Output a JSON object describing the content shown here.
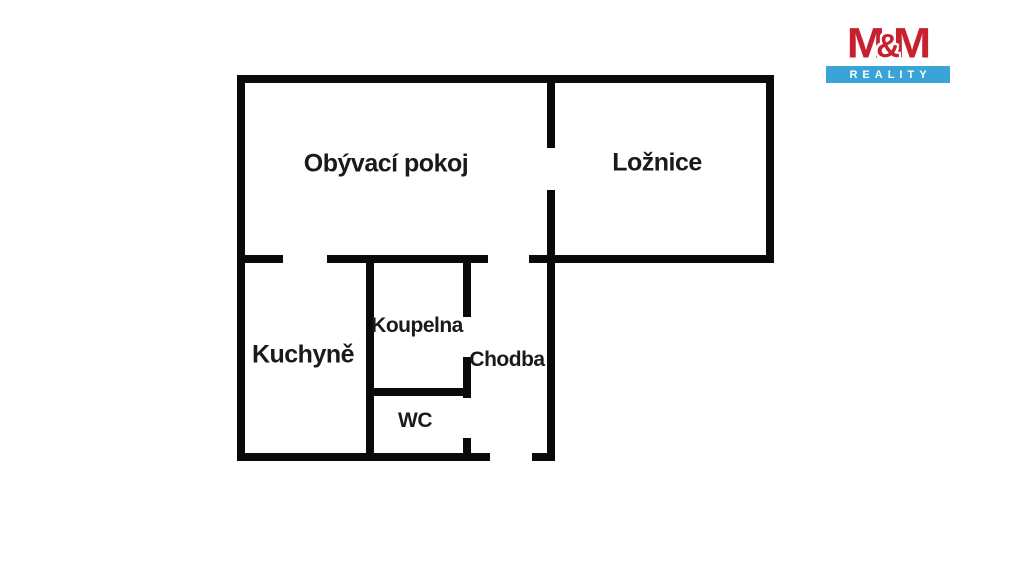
{
  "floorplan": {
    "wall_color": "#0a0a0a",
    "rooms": [
      {
        "id": "obyvaci-pokoj",
        "label": "Obývací pokoj"
      },
      {
        "id": "loznice",
        "label": "Ložnice"
      },
      {
        "id": "kuchyne",
        "label": "Kuchyně"
      },
      {
        "id": "koupelna",
        "label": "Koupelna"
      },
      {
        "id": "chodba",
        "label": "Chodba"
      },
      {
        "id": "wc",
        "label": "WC"
      }
    ]
  },
  "logo": {
    "brand": "M&M",
    "m1": "M",
    "amp": "&",
    "m2": "M",
    "tagline": "REALITY",
    "colors": {
      "red": "#c7202e",
      "blue": "#3aa4d8",
      "tagline_text": "#ffffff"
    }
  }
}
